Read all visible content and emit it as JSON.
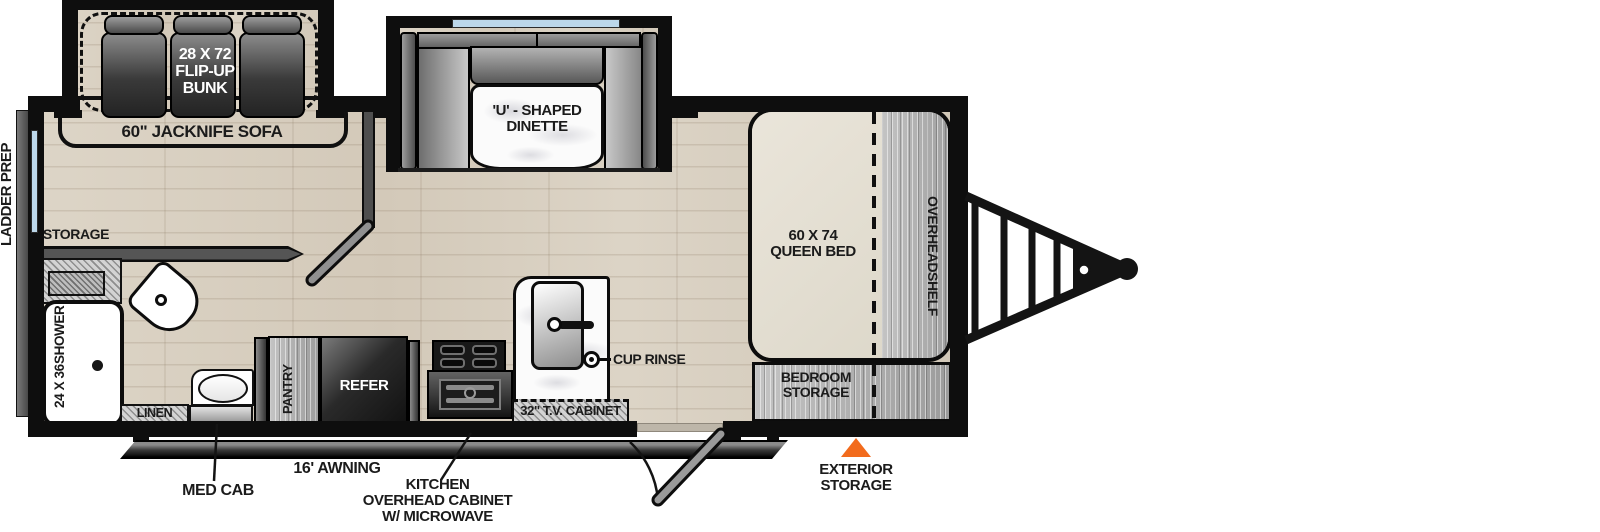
{
  "diagram": {
    "kind": "travel-trailer floorplan, hitch on right",
    "colors": {
      "accent_orange": "#F26B1D",
      "window_blue": "#BCD7EA",
      "wall_black": "#0E0E0E",
      "floor_wood": "#D9D0C2",
      "bed_beige": "#E7E2D5",
      "cabinet_gray": "#B1B1B1"
    },
    "labels": {
      "ladder_prep": "LADDER PREP",
      "flip_up_bunk": [
        "28 X 72",
        "FLIP-UP",
        "BUNK"
      ],
      "jacknife_sofa": "60\" JACKNIFE SOFA",
      "dinette": [
        "'U' - SHAPED",
        "DINETTE"
      ],
      "storage": "STORAGE",
      "shower": [
        "24 X 36",
        "SHOWER"
      ],
      "linen": "LINEN",
      "med_cab": "MED CAB",
      "pantry": "PANTRY",
      "refer": "REFER",
      "cup_rinse": "CUP RINSE",
      "tv_cabinet": "32\" T.V. CABINET",
      "awning": "16' AWNING",
      "kitchen_overhead": [
        "KITCHEN",
        "OVERHEAD CABINET",
        "W/ MICROWAVE"
      ],
      "queen_bed": [
        "60 X 74",
        "QUEEN BED"
      ],
      "overhead_shelf": [
        "OVERHEAD",
        "SHELF"
      ],
      "bedroom_storage": [
        "BEDROOM",
        "STORAGE"
      ],
      "exterior_storage": [
        "EXTERIOR",
        "STORAGE"
      ]
    }
  }
}
